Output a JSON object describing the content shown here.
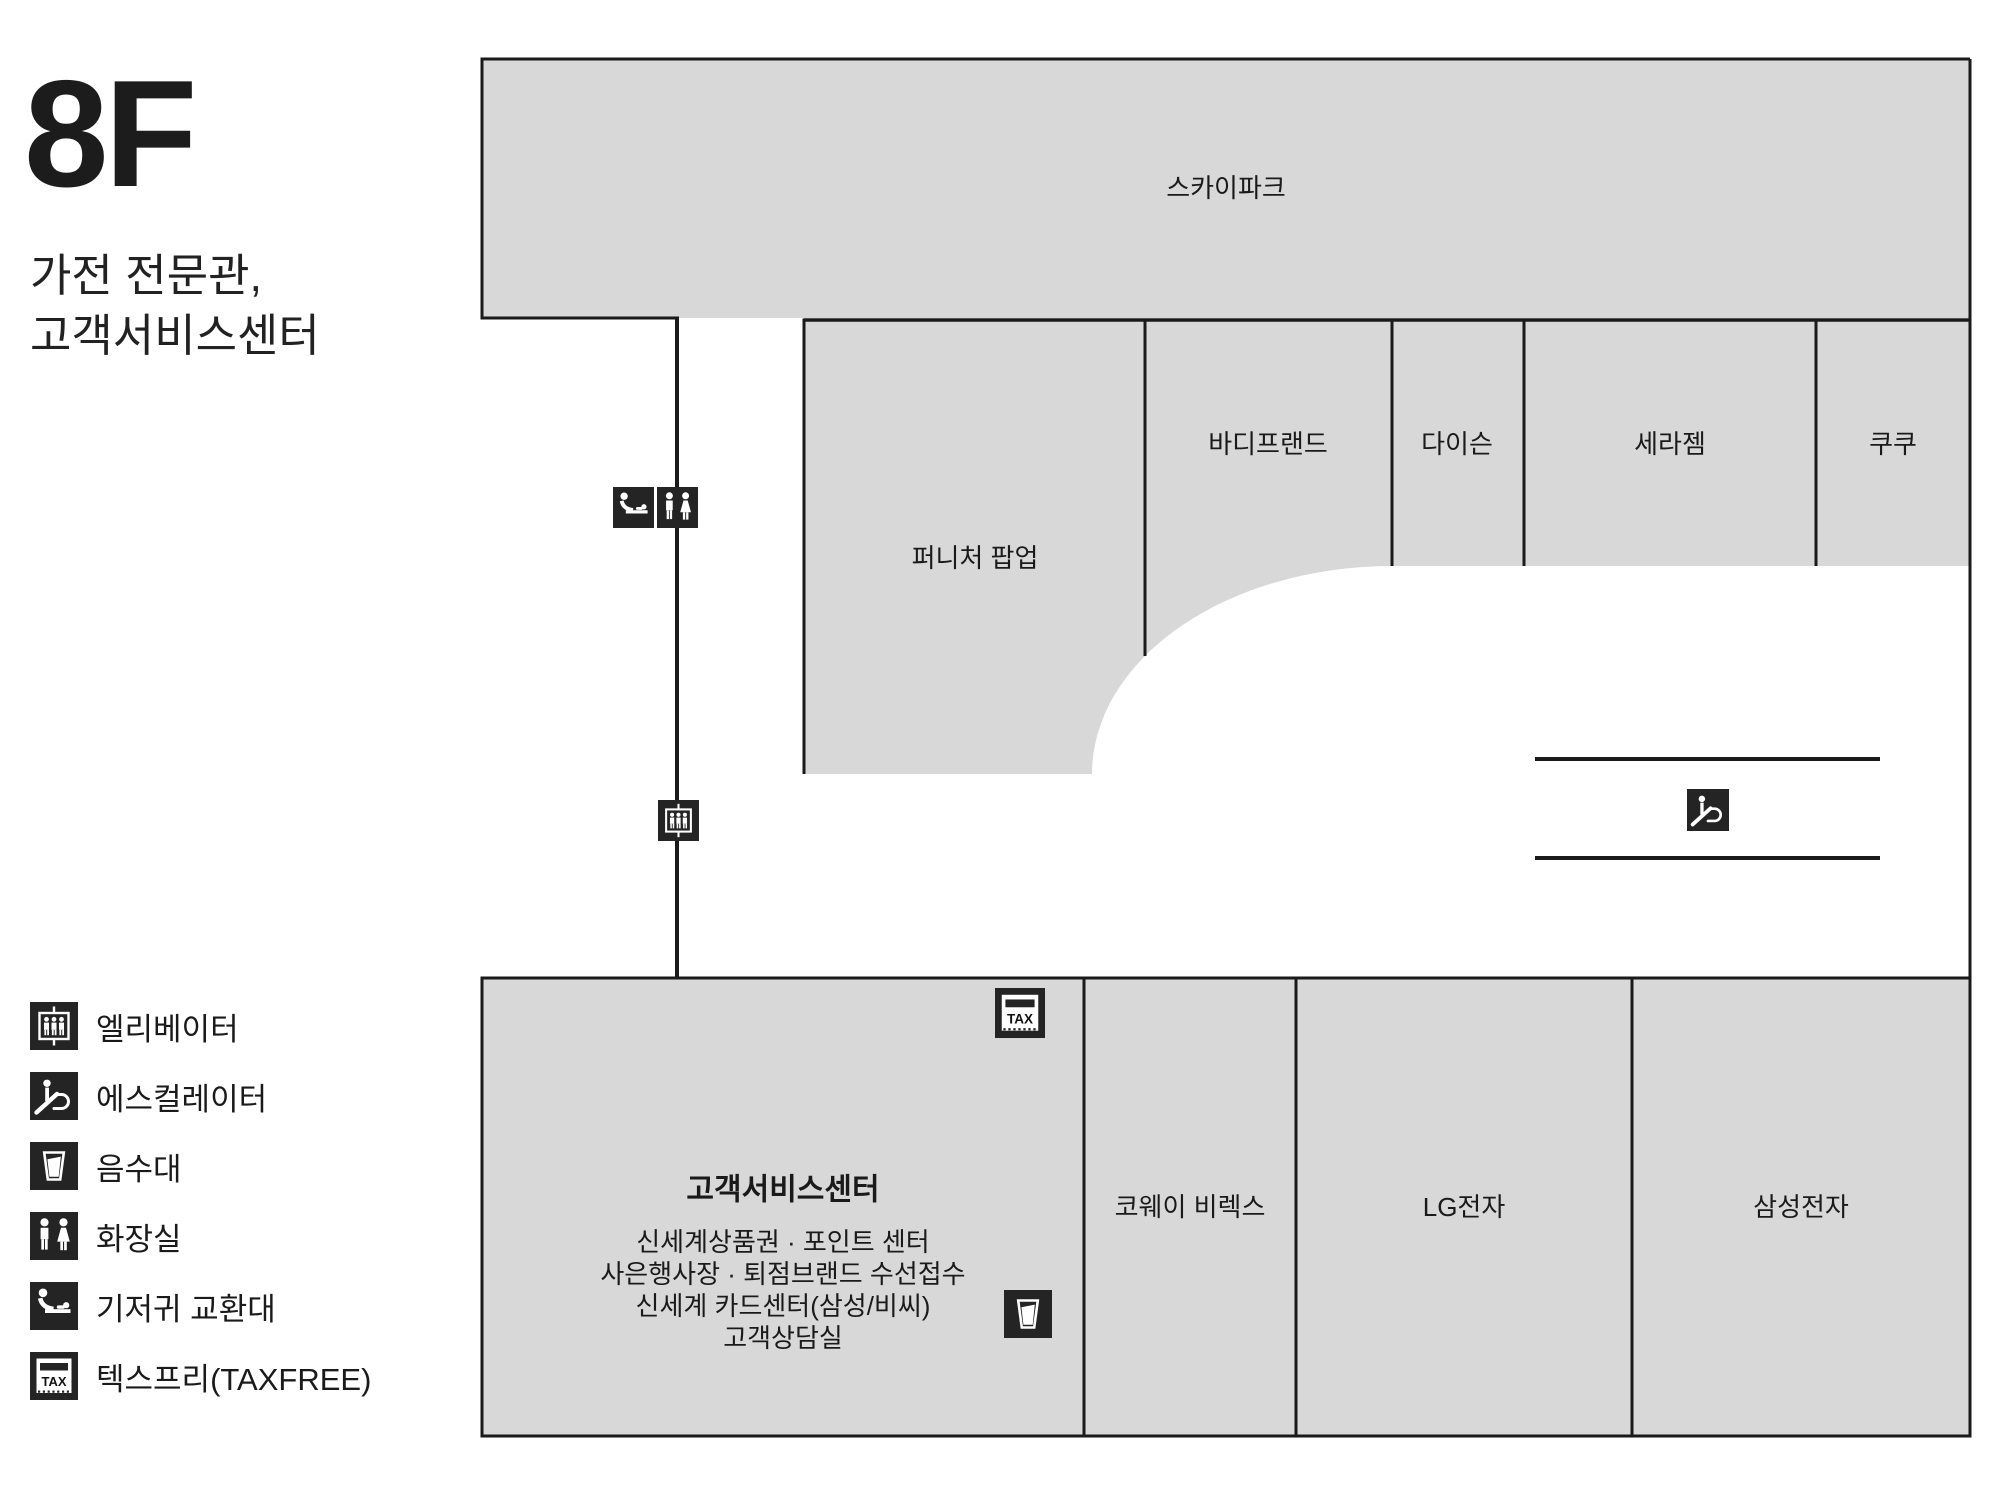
{
  "header": {
    "floor": "8F",
    "subtitle_line1": "가전 전문관,",
    "subtitle_line2": "고객서비스센터"
  },
  "map": {
    "skypark": "스카이파크",
    "furniture_popup": "퍼니처 팝업",
    "bodyfriend": "바디프랜드",
    "dyson": "다이슨",
    "ceragem": "세라젬",
    "cuckoo": "쿠쿠",
    "coway_birex": "코웨이 비렉스",
    "lg": "LG전자",
    "samsung": "삼성전자",
    "service_center": {
      "title": "고객서비스센터",
      "lines": [
        "신세계상품권 · 포인트 센터",
        "사은행사장 · 퇴점브랜드 수선접수",
        "신세계 카드센터(삼성/비씨)",
        "고객상담실"
      ]
    },
    "tax_label": "TAX"
  },
  "legend": {
    "items": [
      {
        "icon": "elevator-icon",
        "label": "엘리베이터"
      },
      {
        "icon": "escalator-icon",
        "label": "에스컬레이터"
      },
      {
        "icon": "drinking-fountain-icon",
        "label": "음수대"
      },
      {
        "icon": "restroom-icon",
        "label": "화장실"
      },
      {
        "icon": "diaper-station-icon",
        "label": "기저귀 교환대"
      },
      {
        "icon": "taxfree-icon",
        "label": "텍스프리(TAXFREE)"
      }
    ]
  },
  "colors": {
    "block_fill": "#d8d8d8",
    "line": "#1a1a1a",
    "icon_bg": "#242424",
    "text": "#1a1a1a"
  }
}
